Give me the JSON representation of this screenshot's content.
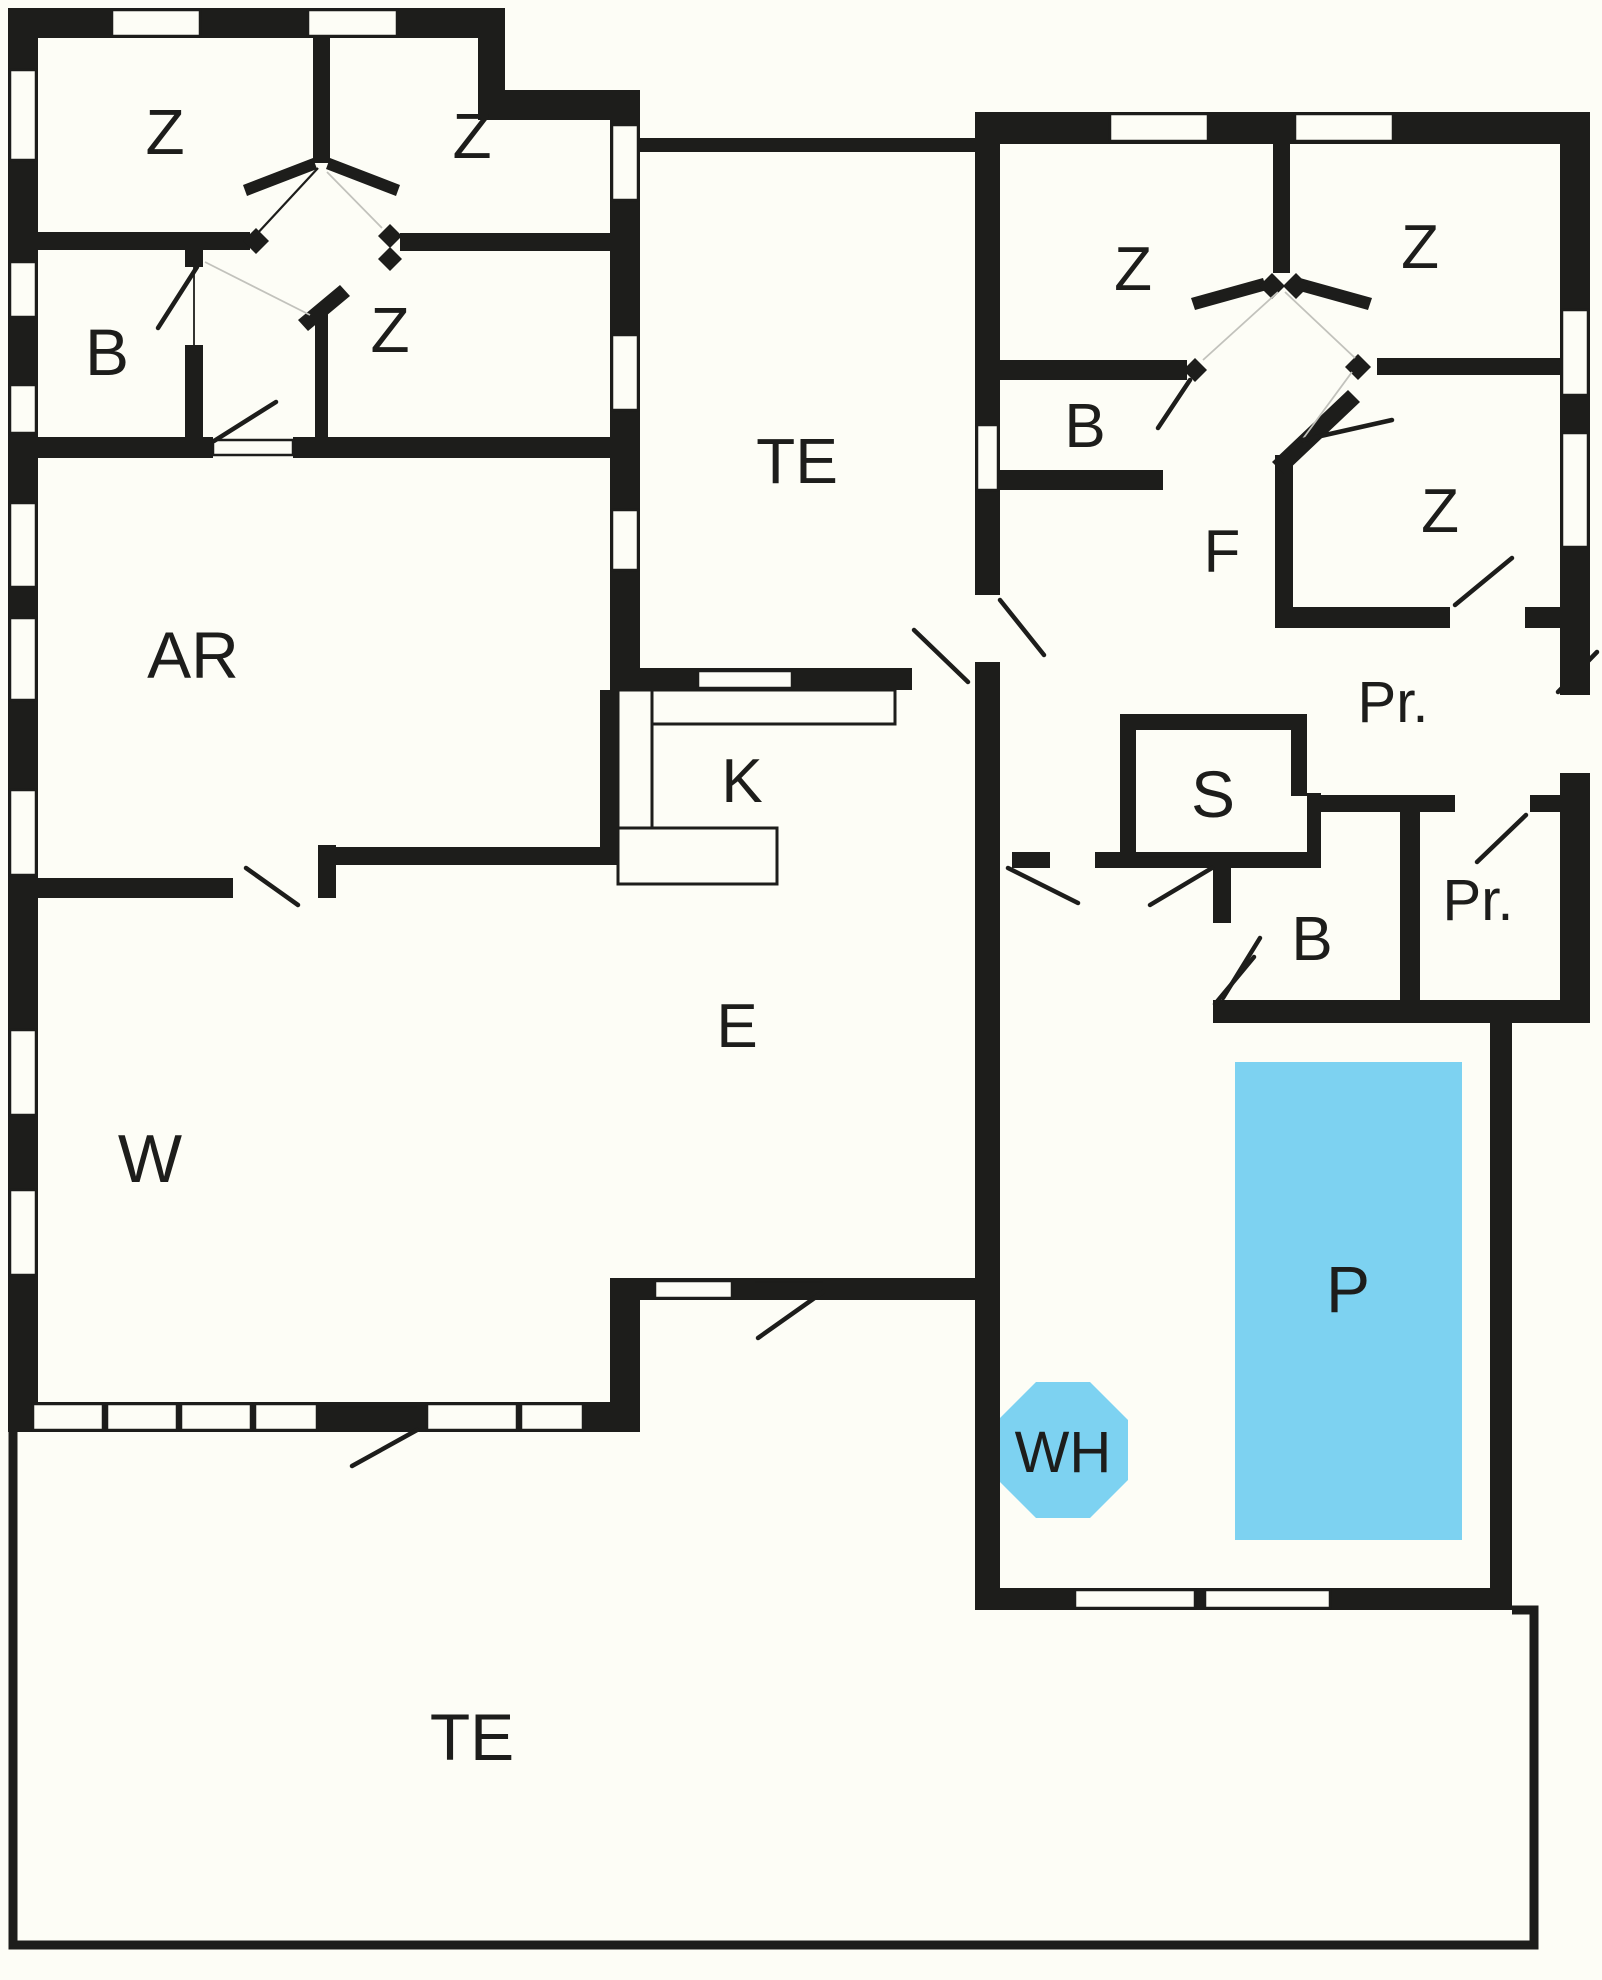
{
  "figure": {
    "type": "floor-plan"
  },
  "colors": {
    "wall": "#1d1d1b",
    "background": "#fdfdf6",
    "water": "#7dd2f1"
  },
  "labels": {
    "bedroom": "Z",
    "bathroom": "B",
    "terrace": "TE",
    "living_room": "AR",
    "lounge": "W",
    "kitchen": "K",
    "entrance": "E",
    "hallway": "F",
    "sauna": "S",
    "storage": "Pr.",
    "pool": "P",
    "whirlpool": "WH"
  }
}
